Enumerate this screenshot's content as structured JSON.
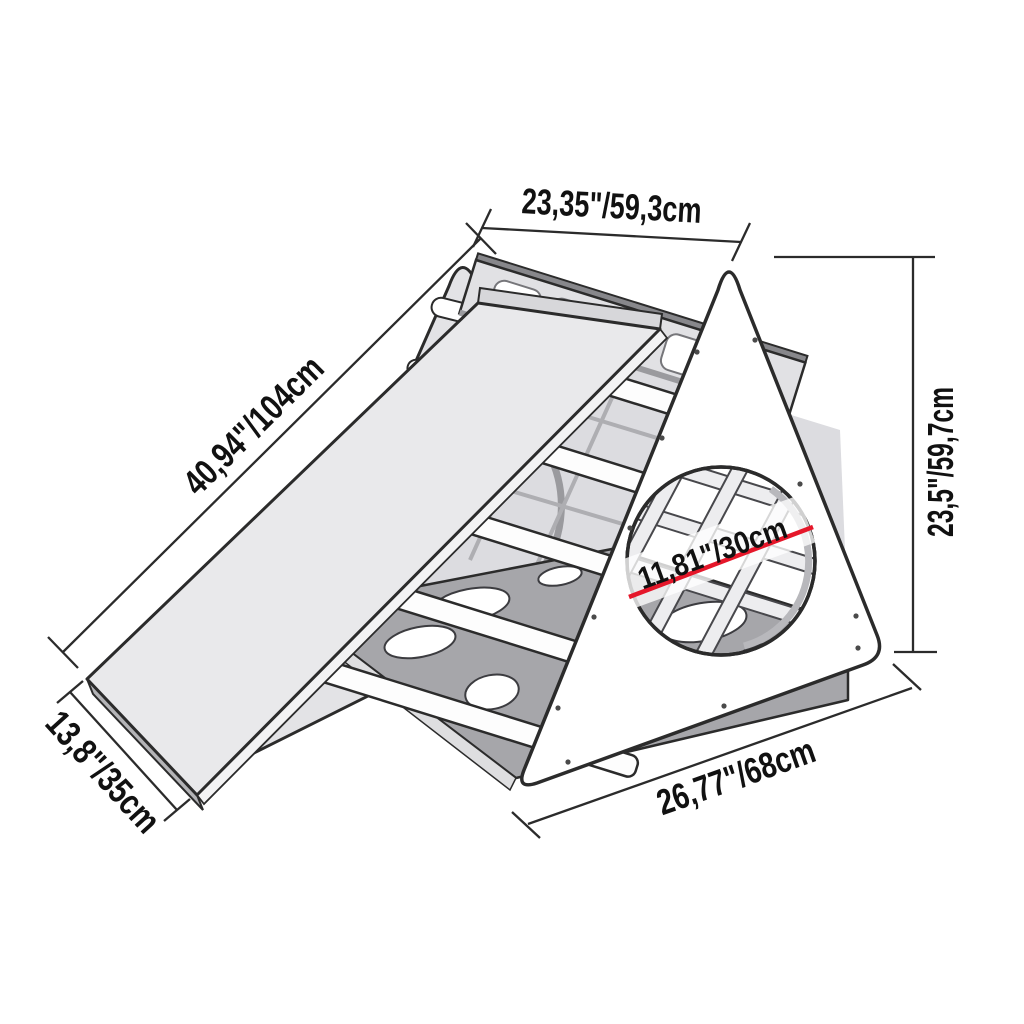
{
  "diagram": {
    "subject": "Climbing triangle with slide and porthole - dimension drawing",
    "colors": {
      "outline": "#2b2b2b",
      "accent": "#e5172a",
      "panel_light": "#e3e3e6",
      "lattice_fill": "#dcdce0",
      "panel_dark": "#a6a6aa",
      "slide_surface": "#e9e9eb",
      "text": "#111111",
      "background": "#ffffff"
    },
    "dimensions": {
      "top_width": "23,35\"/59,3cm",
      "slide_length": "40,94\"/104cm",
      "slide_width": "13,8\"/35cm",
      "height": "23,5\"/59,7cm",
      "porthole_diameter": "11,81\"/30cm",
      "base_width": "26,77\"/68cm"
    }
  }
}
